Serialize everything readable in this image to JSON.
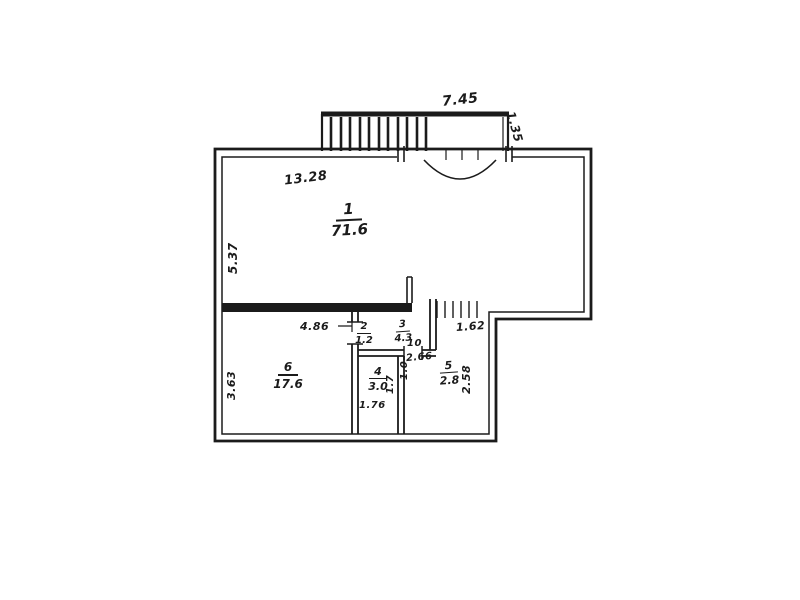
{
  "page": {
    "background": "#ffffff",
    "ink": "#1b1b1b"
  },
  "plan": {
    "rooms": [
      {
        "number": "1",
        "area": "71.6"
      },
      {
        "number": "2",
        "area": "1.2"
      },
      {
        "number": "3",
        "area": "4.3"
      },
      {
        "number": "4",
        "area": "3.0"
      },
      {
        "number": "5",
        "area": "2.8"
      },
      {
        "number": "6",
        "area": "17.6"
      }
    ],
    "dimensions": {
      "stairs_top": "7.45",
      "stairs_right": "1.35",
      "room1_top": "13.28",
      "room1_left": "5.37",
      "room6_top": "4.86",
      "door_center": "10",
      "opening_right": "1.62",
      "center": "2.66",
      "center_vertical": "1.0",
      "room4_side": "1.7",
      "room4_bottom": "1.76",
      "room5_right": "2.58",
      "room6_left": "3.63"
    }
  }
}
